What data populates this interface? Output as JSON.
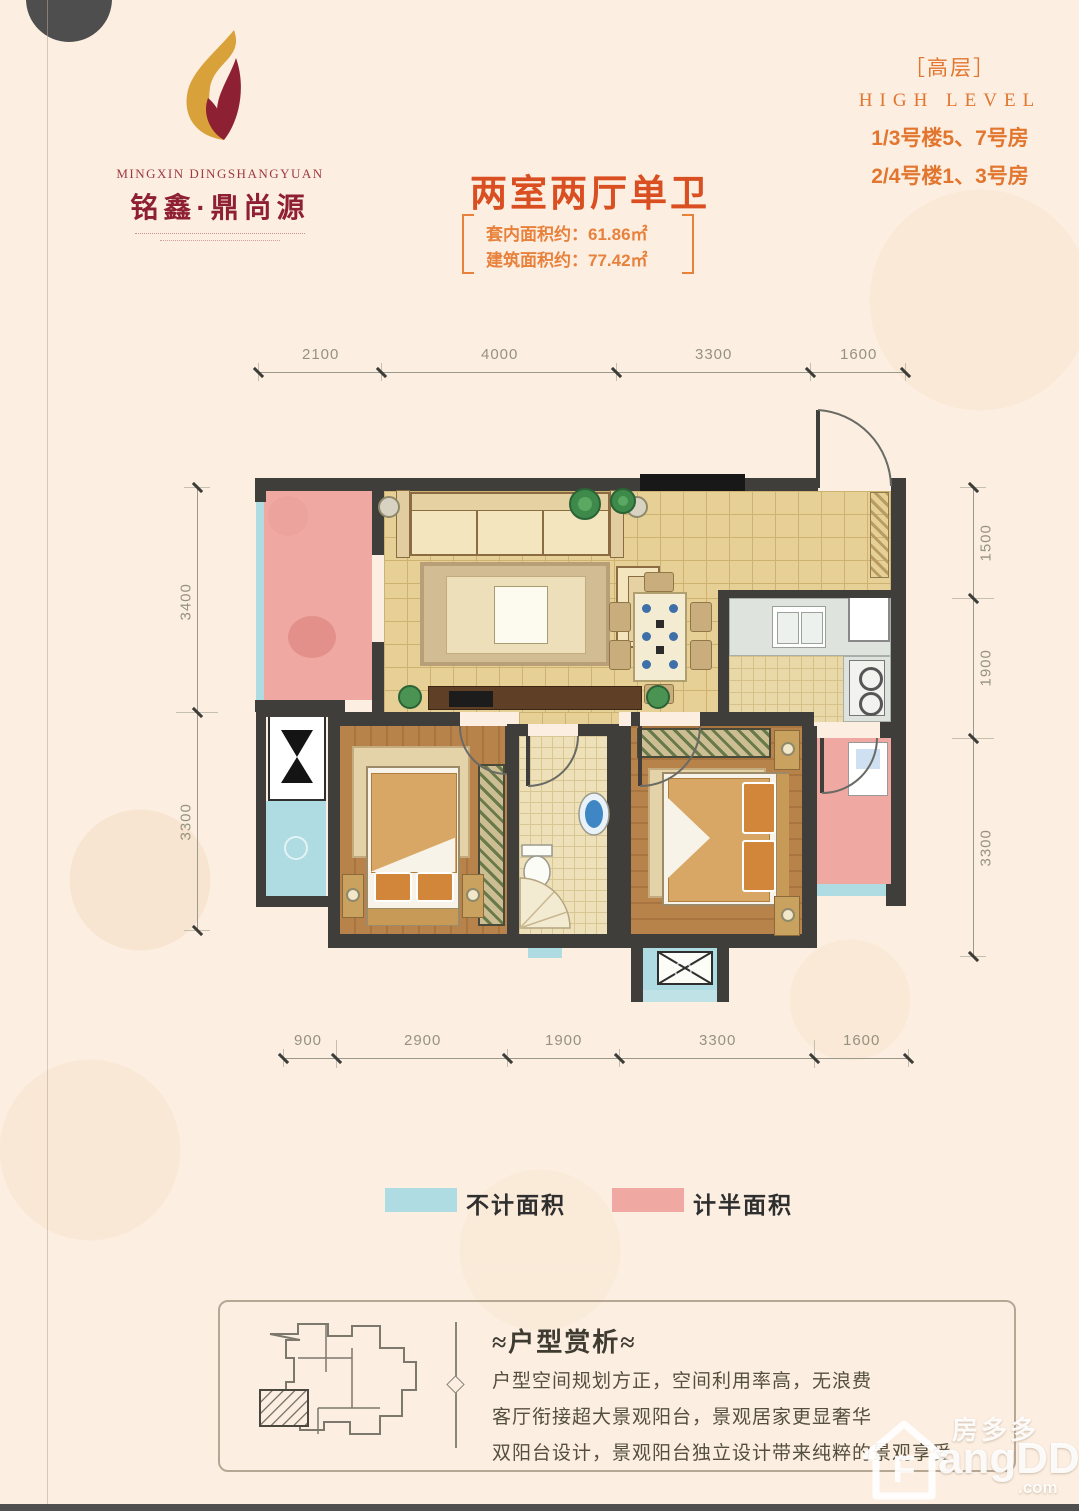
{
  "logo": {
    "en": "MINGXIN DINGSHANGYUAN",
    "cn": "铭鑫·鼎尚源"
  },
  "header": {
    "title": "两室两厅单卫",
    "area_line1": "套内面积约：61.86㎡",
    "area_line2": "建筑面积约：77.42㎡",
    "right_tag": "［高层］",
    "right_en": "HIGH LEVEL",
    "right_line1": "1/3号楼5、7号房",
    "right_line2": "2/4号楼1、3号房"
  },
  "dimensions": {
    "top": [
      "2100",
      "4000",
      "3300",
      "1600"
    ],
    "bottom": [
      "900",
      "2900",
      "1900",
      "3300",
      "1600"
    ],
    "left": [
      "3400",
      "3300"
    ],
    "right": [
      "1500",
      "1900",
      "3300"
    ]
  },
  "legend": {
    "item1": {
      "label": "不计面积",
      "color": "#aedce2"
    },
    "item2": {
      "label": "计半面积",
      "color": "#f0a8a2"
    }
  },
  "analysis": {
    "title": "≈户型赏析≈",
    "line1": "户型空间规划方正，空间利用率高，无浪费",
    "line2": "客厅衔接超大景观阳台，景观居家更显奢华",
    "line3": "双阳台设计，景观阳台独立设计带来纯粹的景观享受"
  },
  "watermark": {
    "cn": "房多多",
    "f": "F",
    "en": "angDD",
    "suffix": ".com"
  },
  "colors": {
    "accent_title": "#d94f21",
    "accent_orange": "#e8813c",
    "logo_red": "#8f1f33",
    "wall": "#3f3e3a",
    "half_area_pink": "#f0a8a2",
    "no_area_blue": "#aedce2",
    "tile_floor": "#e7d096",
    "wood_floor": "#b8834a"
  }
}
